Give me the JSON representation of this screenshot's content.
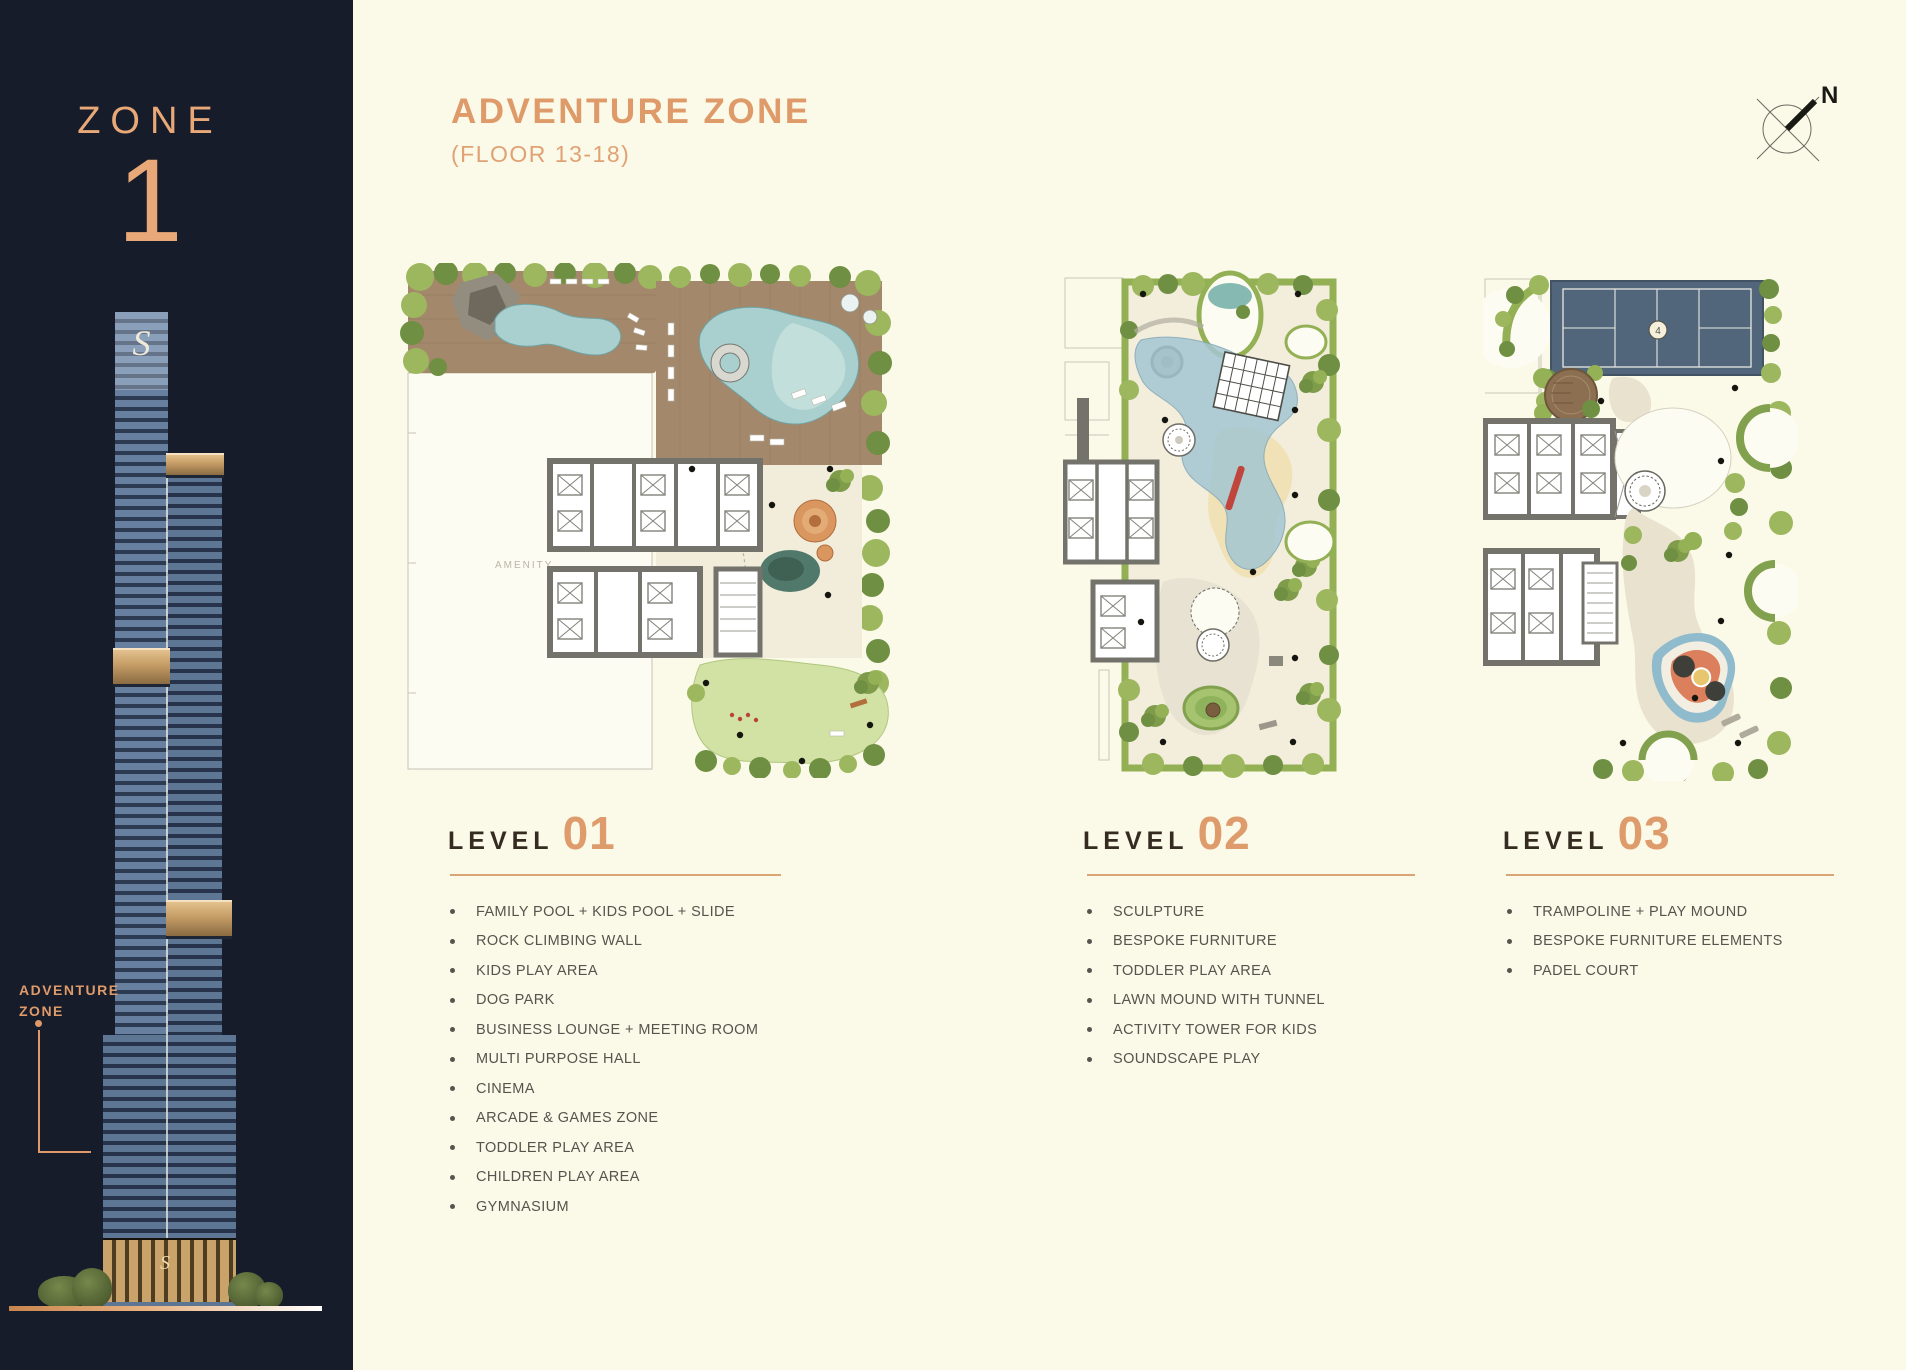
{
  "colors": {
    "accent_copper": "#DE9A69",
    "sidebar_navy": "#171C2A",
    "page_cream": "#FBF9E7",
    "list_text_grey": "#56544D",
    "heading_dark": "#342B21",
    "padel_court_blue": "#52667B",
    "pool_teal": "#A9CFCE",
    "landscape_green": "#93B055"
  },
  "sidebar": {
    "zone_label": "ZONE",
    "zone_number": "1",
    "tower_logo": "S",
    "podium_logo": "S",
    "marker": {
      "line1": "ADVENTURE",
      "line2": "ZONE"
    }
  },
  "header": {
    "title": "ADVENTURE ZONE",
    "subtitle": "(FLOOR 13-18)",
    "compass_label": "N"
  },
  "levels": [
    {
      "label": "LEVEL",
      "number": "01",
      "items": [
        "FAMILY POOL + KIDS POOL + SLIDE",
        "ROCK CLIMBING WALL",
        "KIDS PLAY AREA",
        "DOG PARK",
        "BUSINESS LOUNGE + MEETING ROOM",
        "MULTI PURPOSE HALL",
        "CINEMA",
        "ARCADE & GAMES ZONE",
        "TODDLER PLAY AREA",
        "CHILDREN PLAY AREA",
        "GYMNASIUM"
      ]
    },
    {
      "label": "LEVEL",
      "number": "02",
      "items": [
        "SCULPTURE",
        "BESPOKE FURNITURE",
        "TODDLER PLAY AREA",
        "LAWN MOUND WITH TUNNEL",
        "ACTIVITY TOWER FOR KIDS",
        "SOUNDSCAPE PLAY"
      ]
    },
    {
      "label": "LEVEL",
      "number": "03",
      "items": [
        "TRAMPOLINE + PLAY MOUND",
        "BESPOKE FURNITURE ELEMENTS",
        "PADEL COURT"
      ]
    }
  ],
  "plans": {
    "level01": {
      "room_label": "AMENITY"
    },
    "level03": {
      "court_badge": "4"
    }
  }
}
